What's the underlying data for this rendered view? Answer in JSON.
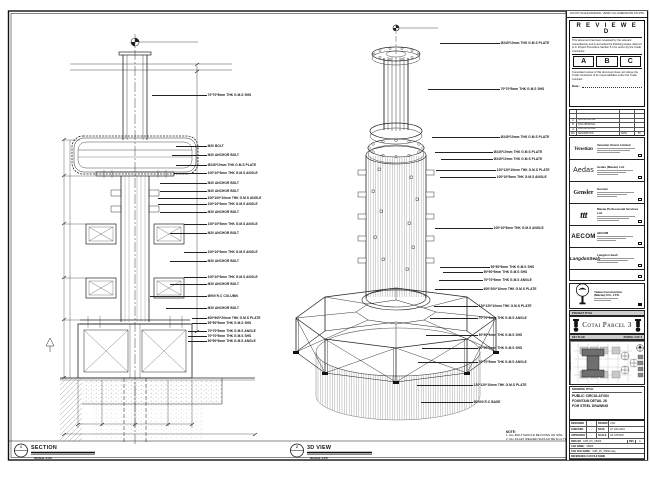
{
  "sheet": {
    "top_strip": "DO NOT SCALE DRAWING. VERIFY ALL DIMENSIONS ON SITE",
    "stamp": {
      "title": "R E V I E W E D",
      "body": "This document has been reviewed by the relevant Consultant(s) and is accorded the following status referred to in Project Procedure Section 5.4 for action by the Trade Contractor.",
      "options": [
        "A",
        "B",
        "C"
      ],
      "footer": "Consultant review of this document does not relieve the Trade Contractor of its responsibilities under the Trade Contract.",
      "date_label": "Date :"
    },
    "revisions": {
      "rows": [
        {
          "no": "C",
          "desc": "FOR APPROVAL",
          "date": "",
          "by": ""
        },
        {
          "no": "B",
          "desc": "FOR APPROVAL",
          "date": "",
          "by": ""
        },
        {
          "no": "A",
          "desc": "FOR APPROVAL",
          "date": "",
          "by": ""
        }
      ],
      "header": {
        "no": "NO.",
        "desc": "DESCRIPTION",
        "date": "DATE",
        "by": "BY"
      }
    },
    "consultants": [
      {
        "logo": "Venetian",
        "name": "Venetian Orient Limited"
      },
      {
        "logo": "Aedas",
        "name": "Aedas (Macau) Ltd."
      },
      {
        "logo": "Gensler",
        "name": "Gensler"
      },
      {
        "logo": "ttt",
        "name": "Macau Professional Services Ltd."
      },
      {
        "logo": "AECOM",
        "name": "AECOM"
      },
      {
        "logo": "LangdonSeah",
        "name": "Langdon Seah"
      }
    ],
    "contractor": {
      "name_line1": "Yadea Construction",
      "name_line2": "(Macau) CO., LTD."
    },
    "project_title_label": "PROJECT TITLE",
    "project_title": "Cotai Parcel 3",
    "key_plan_label": "KEY PLAN",
    "key_plan_parcel": "PARCEL 3 OF 3",
    "drawing_title_label": "DRAWING TITLE:",
    "drawing_title_lines": [
      "PUBLIC CIRCULATION",
      "FOUNTAIN DETAIL 26",
      "FOR STEEL DRAWING"
    ],
    "fields": {
      "designed_label": "DESIGNED",
      "designed": "-",
      "drawn_label": "DRAWN",
      "drawn": "CAD",
      "checked_label": "CHECKED",
      "checked": "-",
      "date_label": "DATE",
      "date": "07-JUN-2010",
      "approved_label": "APPROVED",
      "approved": "-",
      "scale_label": "SCALE",
      "scale": "AS SHOWN",
      "dwg_label": "DWG NO",
      "dwg_no": "3155_PC_S5000",
      "rev_label": "REV",
      "rev": "C",
      "cad_name_label": "CAD NAME :",
      "cad_name": "S5000",
      "cad_file_label": "CAD FILE NAME :",
      "cad_file": "3155_PC_S5000.dwg",
      "ref_label": "REFERENCE CAD FILE NAME"
    }
  },
  "views": {
    "section": {
      "bubble": "1",
      "title": "SECTION",
      "scale": "SCALE 1:25",
      "callouts": [
        "70*70*5mm THK G.M.S SHS",
        "M20 BOLT",
        "M20 ANCHOR BOLT",
        "Ø345*10mm THK G.M.S PLATE",
        "100*10*5mm THK G.M.S ANGLE",
        "M20 ANCHOR BOLT",
        "M20 ANCHOR BOLT",
        "100*100*10mm THK G.M.S ANGLE",
        "100*10*5mm THK G.M.S ANGLE",
        "M20 ANCHOR BOLT",
        "100*10*5mm THK G.M.S ANGLE",
        "M20 ANCHOR BOLT",
        "100*10*5mm THK G.M.S ANGLE",
        "M20 ANCHOR BOLT",
        "100*10*5mm THK G.M.S ANGLE",
        "M20 ANCHOR BOLT",
        "Ø900 R.C COLUMN",
        "M20 ANCHOR BOLT",
        "600*600*20mm THK G.M.S PLATE",
        "50*50*5mm THK G.M.S SHS",
        "70*70*5mm THK G.M.S ANGLE",
        "70*70*5mm THK G.M.S SHS",
        "50*50*5mm THK G.M.S ANGLE"
      ]
    },
    "iso": {
      "bubble": "2",
      "title": "3D VIEW",
      "scale": "SCALE 1:25",
      "callouts": [
        "Ø345*10mm THK G.M.S PLATE",
        "70*70*5mm THK G.M.S SHS",
        "Ø345*10mm THK G.M.S PLATE",
        "Ø345*10mm THK G.M.S PLATE",
        "Ø345*10mm THK G.M.S PLATE",
        "120*120*10mm THK G.M.S PLATE",
        "100*10*5mm THK G.M.S ANGLE",
        "100*10*5mm THK G.M.S ANGLE",
        "50*50*5mm THK G.M.S SHS",
        "50*50*5mm THK G.M.S SHS",
        "70*70*5mm THK G.M.S ANGLE",
        "600*200*10mm THK G.M.S PLATE",
        "120*120*10mm THK G.M.S PLATE",
        "70*70*5mm THK G.M.S ANGLE",
        "50*50*5mm THK G.M.S SHS",
        "50*50*5mm THK G.M.S SHS",
        "70*70*5mm THK G.M.S ANGLE",
        "120*120*10mm THK G.M.S PLATE",
        "Ø2900 R.C BASE"
      ]
    }
  },
  "notes": {
    "title": "NOTE:",
    "items": [
      "1. ALL BOLT SHOULD BE FIXING ON SITE.",
      "2. ALL FILLET WELDED SHOULD BE 6mm THK."
    ]
  }
}
